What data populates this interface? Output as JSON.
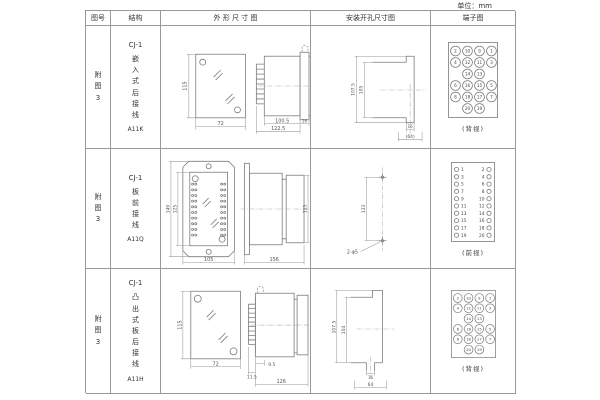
{
  "unit_label": "单位：mm",
  "headers": {
    "figure_no": "图号",
    "structure": "结构",
    "outline": "外 形 尺 寸 图",
    "install": "安装开孔尺寸图",
    "terminal": "端子图"
  },
  "rows": [
    {
      "figure_no": "附图3",
      "model": "CJ-1",
      "structure": "嵌入式后接线",
      "code": "A11K",
      "outline": {
        "front_h": "115",
        "front_w": "72",
        "side_body": "100.5",
        "side_flange": "16",
        "side_total": "122.5"
      },
      "install": {
        "v_outer": "107.5",
        "v_inner": "105",
        "h_slot": "16",
        "h_total": "(64)"
      },
      "terminal_caption": "(背视)"
    },
    {
      "figure_no": "附图3",
      "model": "CJ-1",
      "structure": "板前接线",
      "code": "A11Q",
      "outline": {
        "front_h": "149",
        "front_h_inner": "125",
        "front_w": "105",
        "side_len": "156",
        "side_h": "115"
      },
      "install": {
        "v": "133",
        "holes": "2-φ5"
      },
      "terminal_caption": "(前视)"
    },
    {
      "figure_no": "附图3",
      "model": "CJ-1",
      "structure": "凸出式板后接线",
      "code": "A11H",
      "outline": {
        "front_h": "115",
        "front_w": "72",
        "pin_d": "9.5",
        "pin_d2": "11.5",
        "side_total": "126"
      },
      "install": {
        "v_outer": "107.5",
        "v_inner": "104",
        "h_slot": "16",
        "h_total": "64"
      },
      "terminal_caption": "(背视)"
    }
  ],
  "terminal_grids": {
    "grid4": {
      "rows": [
        [
          "2",
          "10",
          "9",
          "1"
        ],
        [
          "4",
          "12",
          "11",
          "3"
        ],
        [
          "",
          "14",
          "13",
          ""
        ],
        [
          "6",
          "16",
          "15",
          "5"
        ],
        [
          "8",
          "18",
          "17",
          "7"
        ],
        [
          "",
          "20",
          "19",
          ""
        ]
      ]
    },
    "grid2": {
      "left": [
        "1",
        "3",
        "5",
        "7",
        "9",
        "11",
        "13",
        "15",
        "17",
        "19"
      ],
      "right": [
        "2",
        "4",
        "6",
        "8",
        "10",
        "12",
        "14",
        "16",
        "18",
        "20"
      ]
    }
  }
}
